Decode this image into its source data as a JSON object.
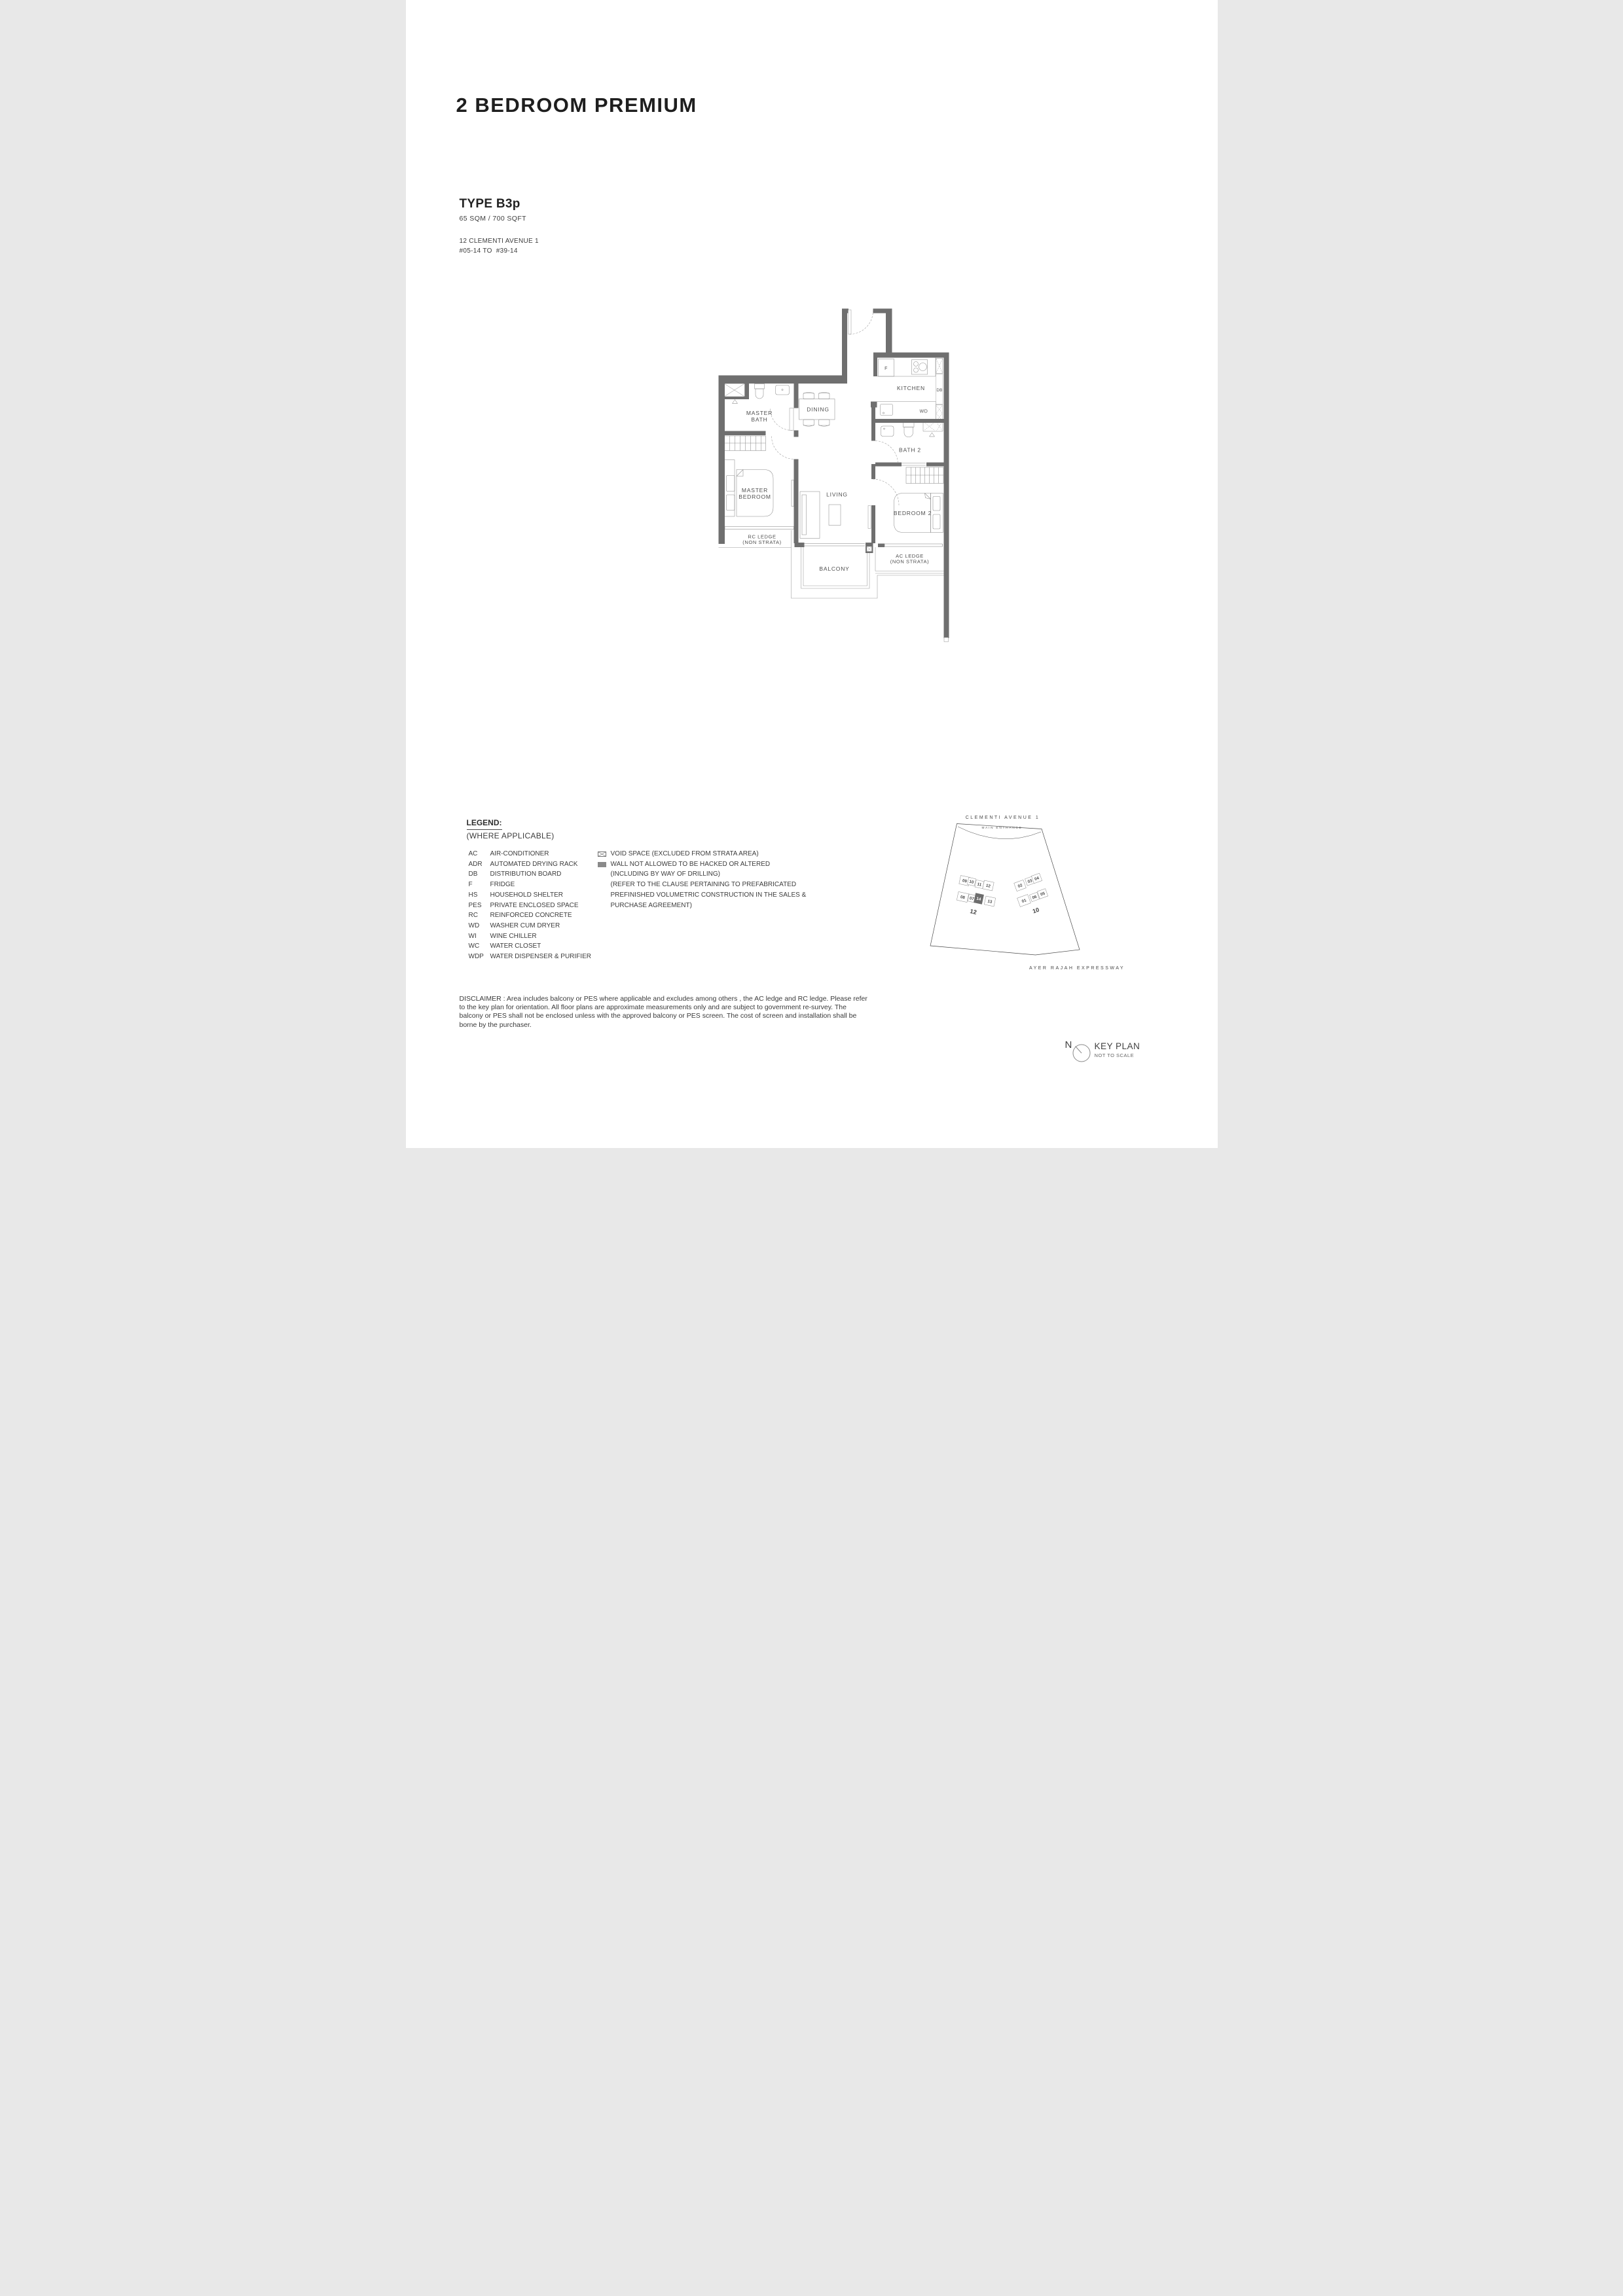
{
  "title": "2 BEDROOM PREMIUM",
  "unit_info": {
    "type": "TYPE B3p",
    "area": "65 SQM / 700 SQFT",
    "address": "12 CLEMENTI AVENUE 1",
    "stack": "#05-14 TO  #39-14"
  },
  "floorplan": {
    "labels": {
      "master_bath_1": "MASTER",
      "master_bath_2": "BATH",
      "dining": "DINING",
      "kitchen": "KITCHEN",
      "fridge": "F",
      "db": "DB",
      "wd": "WD",
      "bath2": "BATH 2",
      "master_bedroom_1": "MASTER",
      "master_bedroom_2": "BEDROOM",
      "living": "LIVING",
      "bedroom2": "BEDROOM 2",
      "rc_ledge_1": "RC LEDGE",
      "rc_ledge_2": "(NON STRATA)",
      "balcony": "BALCONY",
      "ac_ledge_1": "AC LEDGE",
      "ac_ledge_2": "(NON STRATA)"
    }
  },
  "legend": {
    "heading": "LEGEND:",
    "subheading": "(WHERE APPLICABLE)",
    "items": [
      {
        "abbr": "AC",
        "label": "AIR-CONDITIONER"
      },
      {
        "abbr": "ADR",
        "label": "AUTOMATED DRYING RACK"
      },
      {
        "abbr": "DB",
        "label": "DISTRIBUTION BOARD"
      },
      {
        "abbr": "F",
        "label": "FRIDGE"
      },
      {
        "abbr": "HS",
        "label": "HOUSEHOLD SHELTER"
      },
      {
        "abbr": "PES",
        "label": "PRIVATE ENCLOSED SPACE"
      },
      {
        "abbr": "RC",
        "label": "REINFORCED CONCRETE"
      },
      {
        "abbr": "WD",
        "label": "WASHER CUM DRYER"
      },
      {
        "abbr": "WI",
        "label": "WINE CHILLER"
      },
      {
        "abbr": "WC",
        "label": "WATER CLOSET"
      },
      {
        "abbr": "WDP",
        "label": "WATER DISPENSER & PURIFIER"
      }
    ],
    "symbols": [
      {
        "icon": "void-space-icon",
        "label": "VOID SPACE (EXCLUDED FROM STRATA AREA)"
      },
      {
        "icon": "wall-icon",
        "label": "WALL NOT ALLOWED TO BE HACKED OR ALTERED"
      }
    ],
    "symbol_notes": [
      "(INCLUDING BY WAY OF DRILLING)",
      "(REFER TO THE CLAUSE PERTAINING TO PREFABRICATED",
      "PREFINISHED VOLUMETRIC CONSTRUCTION IN THE SALES &",
      "PURCHASE AGREEMENT)"
    ]
  },
  "disclaimer": "DISCLAIMER : Area includes balcony or PES where applicable and excludes among others , the AC ledge and RC ledge. Please refer to the key plan for orientation. All floor plans are approximate measurements only and are subject to government re-survey. The balcony or PES shall not be enclosed unless with the approved balcony or PES screen. The cost of screen and installation shall be borne by the purchaser.",
  "keyplan": {
    "road_top": "CLEMENTI AVENUE 1",
    "main_entrance": "MAIN ENTRANCE",
    "road_bottom": "AYER RAJAH EXPRESSWAY",
    "blocks": [
      "12",
      "10"
    ],
    "units": [
      "09",
      "10",
      "11",
      "12",
      "08",
      "07",
      "14",
      "13",
      "02",
      "03",
      "04",
      "01",
      "06",
      "05"
    ],
    "highlighted_unit": "14"
  },
  "keyplan_legend": {
    "north": "N",
    "title": "KEY PLAN",
    "subtitle": "NOT TO SCALE"
  },
  "colors": {
    "wall": "#6f6f6f",
    "highlight": "#6d6d6d",
    "text": "#4a4a4a"
  }
}
